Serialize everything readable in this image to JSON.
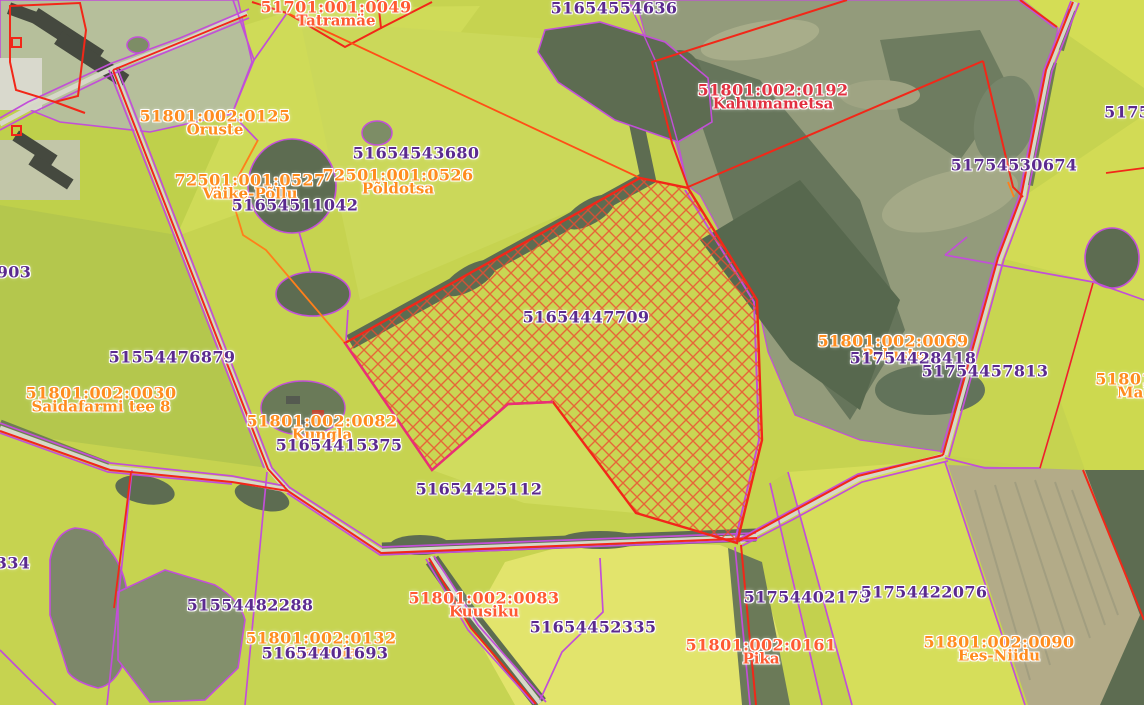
{
  "map": {
    "description": "Cadastral parcel web map over aerial imagery",
    "highlighted_parcel": "51654447709",
    "labels": [
      {
        "code": "51701:001:0049",
        "name": "Tatramäe",
        "x": 336,
        "y": 14,
        "color": "orangered"
      },
      {
        "code": "51654554636",
        "name": "",
        "x": 614,
        "y": 8,
        "color": "purple"
      },
      {
        "code": "51801:002:0192",
        "name": "Kahumametsa",
        "x": 773,
        "y": 97,
        "color": "red"
      },
      {
        "code": "51754",
        "name": "",
        "x": 1133,
        "y": 112,
        "color": "purple"
      },
      {
        "code": "51801:002:0125",
        "name": "Oruste",
        "x": 215,
        "y": 123,
        "color": "orange"
      },
      {
        "code": "51654543680",
        "name": "",
        "x": 416,
        "y": 153,
        "color": "purple"
      },
      {
        "code": "72501:001:0526",
        "name": "Põldotsa",
        "x": 398,
        "y": 182,
        "color": "orange"
      },
      {
        "code": "72501:001:0527",
        "name": "Väike-Põllu",
        "x": 250,
        "y": 187,
        "color": "orange"
      },
      {
        "code": "51654511042",
        "name": "",
        "x": 295,
        "y": 205,
        "color": "purple"
      },
      {
        "code": "51754530674",
        "name": "",
        "x": 1014,
        "y": 165,
        "color": "purple"
      },
      {
        "code": "903",
        "name": "",
        "x": 14,
        "y": 272,
        "color": "purple"
      },
      {
        "code": "51654447709",
        "name": "",
        "x": 586,
        "y": 317,
        "color": "purple"
      },
      {
        "code": "51554476879",
        "name": "",
        "x": 172,
        "y": 357,
        "color": "purple"
      },
      {
        "code": "51801:002:0069",
        "name": "Paluste",
        "x": 893,
        "y": 348,
        "color": "orange"
      },
      {
        "code": "51754428418",
        "name": "",
        "x": 913,
        "y": 358,
        "color": "purple"
      },
      {
        "code": "51754457813",
        "name": "",
        "x": 985,
        "y": 371,
        "color": "purple"
      },
      {
        "code": "51801:0",
        "name": "Mal",
        "x": 1133,
        "y": 386,
        "color": "orange"
      },
      {
        "code": "51801:002:0030",
        "name": "Saidafarmi tee 8",
        "x": 101,
        "y": 400,
        "color": "orange"
      },
      {
        "code": "51801:002:0082",
        "name": "Kungla",
        "x": 322,
        "y": 428,
        "color": "orange"
      },
      {
        "code": "51654415375",
        "name": "",
        "x": 339,
        "y": 445,
        "color": "purple"
      },
      {
        "code": "51654425112",
        "name": "",
        "x": 479,
        "y": 489,
        "color": "purple"
      },
      {
        "code": "334",
        "name": "",
        "x": 13,
        "y": 563,
        "color": "purple"
      },
      {
        "code": "51554482288",
        "name": "",
        "x": 250,
        "y": 605,
        "color": "purple"
      },
      {
        "code": "51801:002:0083",
        "name": "Kuusiku",
        "x": 484,
        "y": 605,
        "color": "orangered"
      },
      {
        "code": "51654452335",
        "name": "",
        "x": 593,
        "y": 627,
        "color": "purple"
      },
      {
        "code": "51754402173",
        "name": "",
        "x": 807,
        "y": 597,
        "color": "purple"
      },
      {
        "code": "51754422076",
        "name": "",
        "x": 924,
        "y": 592,
        "color": "purple"
      },
      {
        "code": "51801:002:0132",
        "name": "Saareaia",
        "x": 321,
        "y": 645,
        "color": "orange"
      },
      {
        "code": "51654401693",
        "name": "",
        "x": 325,
        "y": 653,
        "color": "purple"
      },
      {
        "code": "51801:002:0161",
        "name": "Pika",
        "x": 761,
        "y": 652,
        "color": "orangered"
      },
      {
        "code": "51801:002:0090",
        "name": "Ees-Niidu",
        "x": 999,
        "y": 649,
        "color": "orange"
      }
    ],
    "label_colors": {
      "code_purple": "#5b2a8f",
      "orange": "#ff8c1e",
      "orangered": "#ff5a32",
      "red": "#e23040",
      "halo": "#ffffff"
    },
    "boundary_colors": {
      "parcel_red": "#f22718",
      "parcel_purple": "#c24fd8",
      "parcel_orange": "#ff7f1a",
      "selection_magenta": "#e8308a",
      "hatch_stroke": "#ee4a30"
    },
    "terrain_colors": {
      "field_base": "#c6d350",
      "field_bright": "#d6de5a",
      "field_pale_yellow": "#e2e46c",
      "forest_dark": "#5d6c51",
      "scrub_grey_green": "#939b7b",
      "road_grey": "#d6d8c8",
      "brown_field": "#b3ab88"
    }
  }
}
